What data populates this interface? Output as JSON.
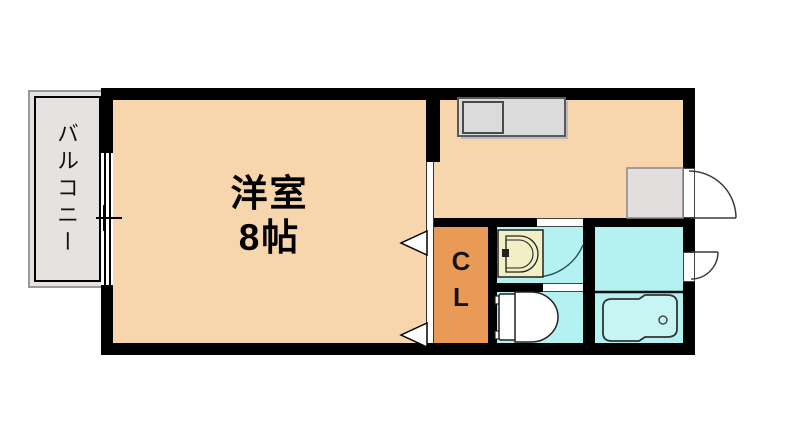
{
  "title": "apartment floor plan",
  "balcony": {
    "label": "バルコニー"
  },
  "main_room": {
    "name": "洋室",
    "size": "8帖"
  },
  "closet": {
    "letter_top": "C",
    "letter_bottom": "L"
  },
  "rooms": [
    {
      "name": "balcony",
      "label": "バルコニー"
    },
    {
      "name": "western-room",
      "label": "洋室 8帖"
    },
    {
      "name": "kitchen-dining",
      "label": ""
    },
    {
      "name": "closet",
      "label": "CL"
    },
    {
      "name": "washroom",
      "label": ""
    },
    {
      "name": "toilet-room",
      "label": ""
    },
    {
      "name": "bathroom",
      "label": ""
    }
  ],
  "fixtures": [
    "kitchen-counter",
    "kitchen-sink",
    "entrance-mat",
    "entrance-door",
    "washbasin",
    "toilet",
    "bathtub",
    "bathtub-drain",
    "bathroom-exterior-door",
    "washroom-door",
    "closet-folding-door-marks",
    "balcony-window"
  ],
  "colors": {
    "room_peach": "#F7D6AD",
    "closet_orange": "#E99A57",
    "wet_area_cyan": "#B3F2F1",
    "bathtub_cyan": "#C7F5F3",
    "balcony_gray": "#E6E2E2",
    "entrance_mat_gray": "#E2DEDE",
    "counter_gray": "#DBDBDB",
    "washbasin_cream": "#F3EFC5",
    "wall_black": "#000000"
  }
}
